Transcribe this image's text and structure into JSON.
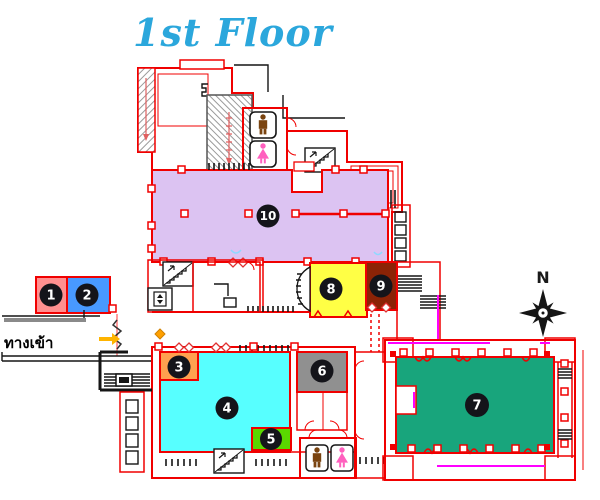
{
  "title": {
    "text": "1st Floor",
    "color": "#2BA7DC"
  },
  "compass": {
    "north_label": "N"
  },
  "entrance": {
    "label": "ทางเข้า",
    "arrow_color": "#FFB400"
  },
  "palette": {
    "wall": "#F00000",
    "magenta": "#FF00FF",
    "male_icon": "#7A4410",
    "female_icon": "#FF5FBE",
    "hatch": "#9A9A9A"
  },
  "rooms": [
    {
      "number": "1",
      "color": "#FF9090"
    },
    {
      "number": "2",
      "color": "#4899FF"
    },
    {
      "number": "3",
      "color": "#FFA14F"
    },
    {
      "number": "4",
      "color": "#57FFFF"
    },
    {
      "number": "5",
      "color": "#5AD800"
    },
    {
      "number": "6",
      "color": "#909090"
    },
    {
      "number": "7",
      "color": "#18A57C"
    },
    {
      "number": "8",
      "color": "#FFFF45"
    },
    {
      "number": "9",
      "color": "#8B2306"
    },
    {
      "number": "10",
      "color": "#DCC3F2"
    }
  ]
}
